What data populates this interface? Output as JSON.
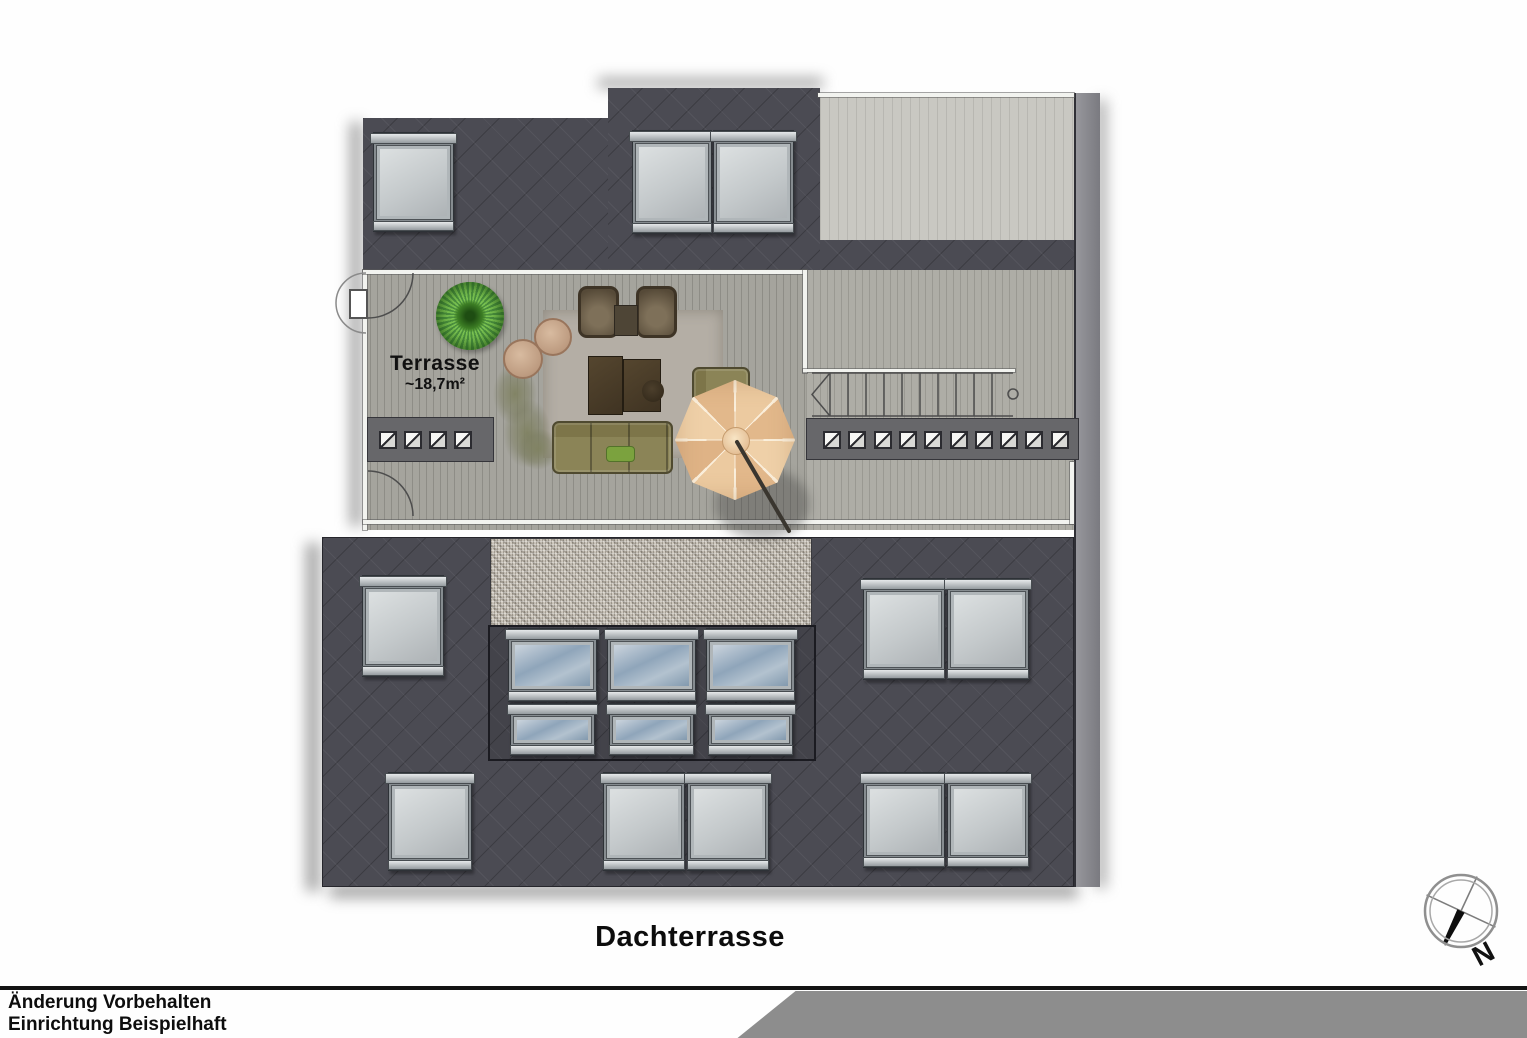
{
  "title": "Dachterrasse",
  "terrace": {
    "label": "Terrasse",
    "area": "~18,7m²"
  },
  "footer": {
    "line1": "Änderung Vorbehalten",
    "line2": "Einrichtung Beispielhaft"
  },
  "compass": {
    "label": "N"
  },
  "colors": {
    "slate": "#4b4b53",
    "deck_light": "#c9c8c2",
    "deck_mid": "#a5a49d",
    "band": "#67676a",
    "footer_band": "#8d8d8d",
    "umbrella": "#eccaa0",
    "plant_green": "#5ea33a",
    "sofa_olive": "#8b8457",
    "glass_blue": "#8fa5ba",
    "glass_gray": "#c4c9cb"
  },
  "plan": {
    "white_lines": [
      {
        "x": 363,
        "y": 270,
        "w": 4,
        "h": 260
      },
      {
        "x": 363,
        "y": 270,
        "w": 443,
        "h": 4
      },
      {
        "x": 803,
        "y": 270,
        "w": 4,
        "h": 103
      },
      {
        "x": 803,
        "y": 369,
        "w": 212,
        "h": 3
      },
      {
        "x": 363,
        "y": 520,
        "w": 710,
        "h": 4
      },
      {
        "x": 1070,
        "y": 462,
        "w": 4,
        "h": 62
      },
      {
        "x": 818,
        "y": 93,
        "w": 256,
        "h": 4
      }
    ],
    "hatch_bands": [
      {
        "x": 367,
        "y": 417,
        "w": 125,
        "h": 43,
        "count": 4,
        "start": 386,
        "spacing": 25,
        "cy": 438
      },
      {
        "x": 806,
        "y": 418,
        "w": 271,
        "h": 40,
        "count": 10,
        "start": 830,
        "spacing": 25.3,
        "cy": 438
      }
    ],
    "windows_gray": [
      {
        "x": 373,
        "y": 132,
        "w": 79,
        "h": 98
      },
      {
        "x": 632,
        "y": 130,
        "w": 78,
        "h": 102
      },
      {
        "x": 713,
        "y": 130,
        "w": 79,
        "h": 102
      },
      {
        "x": 362,
        "y": 575,
        "w": 80,
        "h": 100
      },
      {
        "x": 863,
        "y": 578,
        "w": 80,
        "h": 100
      },
      {
        "x": 947,
        "y": 578,
        "w": 80,
        "h": 100
      },
      {
        "x": 388,
        "y": 772,
        "w": 82,
        "h": 97
      },
      {
        "x": 603,
        "y": 772,
        "w": 80,
        "h": 97
      },
      {
        "x": 687,
        "y": 772,
        "w": 80,
        "h": 97
      },
      {
        "x": 863,
        "y": 772,
        "w": 80,
        "h": 94
      },
      {
        "x": 947,
        "y": 772,
        "w": 80,
        "h": 94
      }
    ],
    "windows_blue_large": [
      {
        "x": 508,
        "y": 628,
        "w": 87,
        "h": 72
      },
      {
        "x": 607,
        "y": 628,
        "w": 87,
        "h": 72
      },
      {
        "x": 706,
        "y": 628,
        "w": 87,
        "h": 72
      }
    ],
    "windows_blue_small": [
      {
        "x": 510,
        "y": 703,
        "w": 83,
        "h": 51
      },
      {
        "x": 609,
        "y": 703,
        "w": 83,
        "h": 51
      },
      {
        "x": 708,
        "y": 703,
        "w": 83,
        "h": 51
      }
    ],
    "stairs": {
      "x1": 812,
      "x2": 1013,
      "y1": 373,
      "y2": 416,
      "tread_start": 830,
      "tread_step": 18,
      "circle_x": 1013,
      "circle_y": 394,
      "circle_r": 5
    },
    "doors": {
      "arc_top": "M413,273 A45,45 0 0 1 368,318",
      "arc_bottom": "M413,516 A45,45 0 0 0 368,471",
      "semi_outside": "M366,273 A30,30 0 0 0 366,333",
      "jamb_rect": {
        "x": 350,
        "y": 290,
        "w": 17,
        "h": 28
      }
    },
    "umbrella_pole": {
      "x1": 737,
      "y1": 442,
      "x2": 789,
      "y2": 531
    }
  },
  "furniture": {
    "plant_spiky": {
      "cx": 470,
      "cy": 316,
      "r": 34
    },
    "rug": {
      "x": 543,
      "y": 310,
      "w": 180,
      "h": 148
    },
    "chairs": [
      {
        "x": 578,
        "y": 286,
        "w": 35,
        "h": 46
      },
      {
        "x": 636,
        "y": 286,
        "w": 35,
        "h": 46
      }
    ],
    "side_table_small": {
      "x": 614,
      "y": 305,
      "w": 22,
      "h": 29
    },
    "round_tables": [
      {
        "cx": 551,
        "cy": 335,
        "r": 17
      },
      {
        "cx": 521,
        "cy": 357,
        "r": 18
      }
    ],
    "coffee_tables": [
      {
        "x": 588,
        "y": 356,
        "w": 33,
        "h": 57
      },
      {
        "x": 623,
        "y": 359,
        "w": 36,
        "h": 51
      }
    ],
    "stool_round": {
      "cx": 653,
      "cy": 391,
      "r": 11
    },
    "sofa_h": {
      "x": 552,
      "y": 421,
      "w": 117,
      "h": 49
    },
    "pillow": {
      "x": 606,
      "y": 446,
      "w": 27,
      "h": 14
    },
    "sofa_v": {
      "x": 692,
      "y": 367,
      "w": 54,
      "h": 63
    },
    "umbrella": {
      "cx": 735,
      "cy": 440,
      "r": 60
    },
    "sprigs": [
      {
        "x": 493,
        "y": 363,
        "w": 44,
        "h": 62
      },
      {
        "x": 503,
        "y": 398,
        "w": 48,
        "h": 70
      },
      {
        "x": 517,
        "y": 428,
        "w": 42,
        "h": 42
      }
    ]
  }
}
